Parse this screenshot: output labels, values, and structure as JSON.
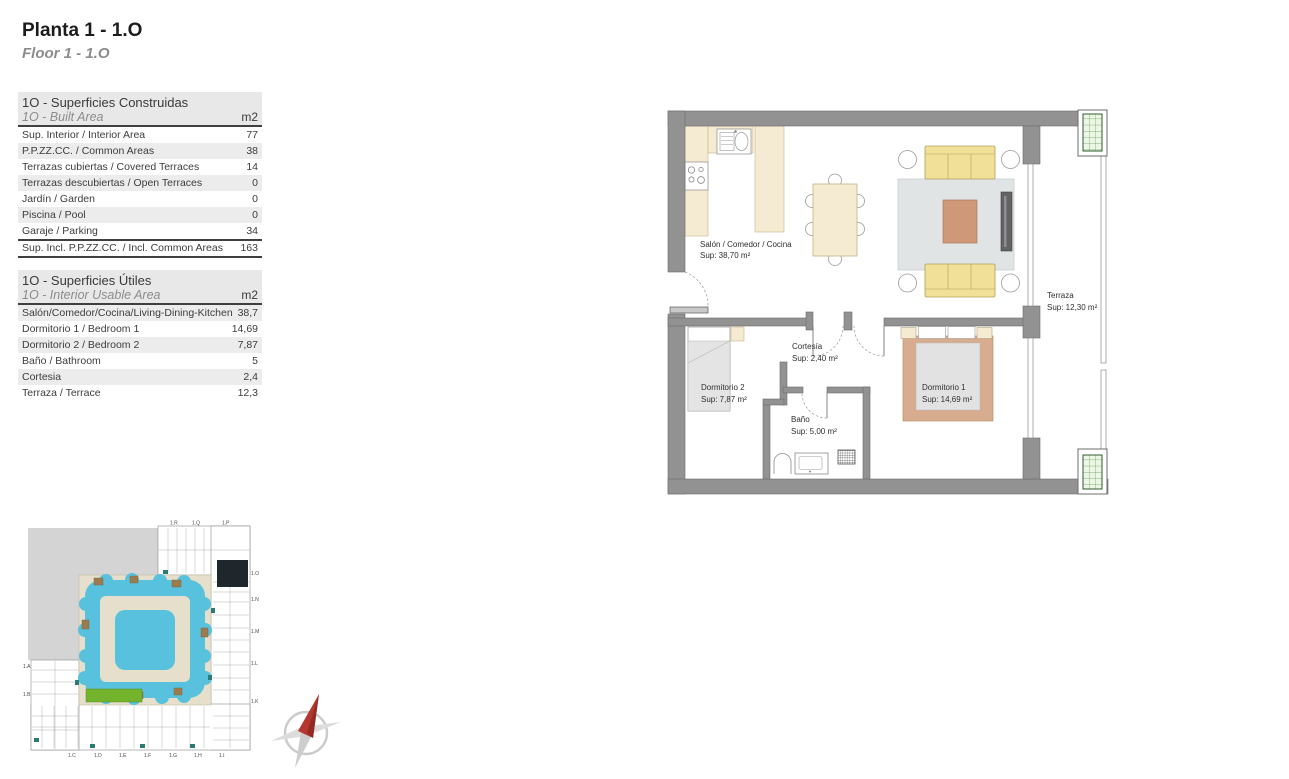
{
  "page": {
    "title": "Planta 1 - 1.O",
    "subtitle": "Floor 1 - 1.O"
  },
  "built_table": {
    "title_es": "1O - Superficies Construidas",
    "title_en": "1O - Built Area",
    "unit": "m2",
    "rows": [
      {
        "label": "Sup. Interior / Interior Area",
        "value": "77"
      },
      {
        "label": "P.P.ZZ.CC. / Common Areas",
        "value": "38"
      },
      {
        "label": "Terrazas cubiertas / Covered Terraces",
        "value": "14"
      },
      {
        "label": "Terrazas descubiertas / Open Terraces",
        "value": "0"
      },
      {
        "label": "Jardín / Garden",
        "value": "0"
      },
      {
        "label": "Piscina / Pool",
        "value": "0"
      },
      {
        "label": "Garaje / Parking",
        "value": "34"
      },
      {
        "label": "Sup. Incl. P.P.ZZ.CC. / Incl. Common Areas",
        "value": "163"
      }
    ]
  },
  "usable_table": {
    "title_es": "1O - Superficies Útiles",
    "title_en": "1O - Interior Usable Area",
    "unit": "m2",
    "rows": [
      {
        "label": "Salón/Comedor/Cocina/Living-Dining-Kitchen",
        "value": "38,7"
      },
      {
        "label": "Dormitorio 1 / Bedroom 1",
        "value": "14,69"
      },
      {
        "label": "Dormitorio 2 / Bedroom 2",
        "value": "7,87"
      },
      {
        "label": "Baño  / Bathroom",
        "value": "5"
      },
      {
        "label": "Cortesia",
        "value": "2,4"
      },
      {
        "label": "Terraza / Terrace",
        "value": "12,3"
      }
    ]
  },
  "floorplan": {
    "rooms": {
      "salon": {
        "name": "Salón / Comedor / Cocina",
        "area": "Sup: 38,70 m²"
      },
      "terraza": {
        "name": "Terraza",
        "area": "Sup: 12,30 m²"
      },
      "cortesia": {
        "name": "Cortesía",
        "area": "Sup: 2,40 m²"
      },
      "dormitorio2": {
        "name": "Dormitorio 2",
        "area": "Sup: 7,87 m²"
      },
      "dormitorio1": {
        "name": "Dormitorio 1",
        "area": "Sup: 14,69 m²"
      },
      "bano": {
        "name": "Baño",
        "area": "Sup: 5,00 m²"
      }
    }
  },
  "siteplan": {
    "highlighted_unit": "1.O",
    "labels": {
      "top": [
        "1.R",
        "1.Q",
        "1.P"
      ],
      "right": [
        "1.O",
        "1.N",
        "1.M",
        "1.L",
        "1.K"
      ],
      "left": [
        "1.A",
        "1.B"
      ],
      "bottom": [
        "1.C",
        "1.D",
        "1.E",
        "1.F",
        "1.G",
        "1.H",
        "1.I"
      ]
    }
  },
  "colors": {
    "wall_gray": "#929292",
    "counter_beige": "#f5ebd3",
    "sofa_yellow": "#f1e098",
    "rug_gray": "#e1e4e5",
    "table_salmon": "#cf9878",
    "bed_salmon": "#d8ac8e",
    "shaft_green": "#5f9b55",
    "pool_blue": "#58c1dd",
    "courtyard_beige": "#e6dfcb",
    "lawn_green": "#74b32c",
    "highlight_black": "#1f262c",
    "compass_red": "#b5372e"
  }
}
